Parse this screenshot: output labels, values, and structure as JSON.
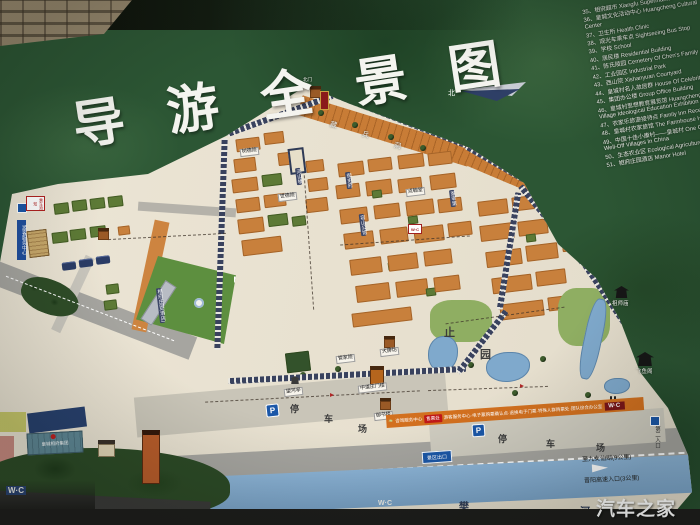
{
  "title": {
    "c1": "导",
    "c2": "游",
    "c3": "全",
    "c4": "景",
    "c5": "图"
  },
  "watermark": "汽车之家",
  "north": {
    "label": "北"
  },
  "legend": {
    "items": [
      "35、相府超市 Xiangfu Supermarket",
      "36、皇城文化活动中心 Huangcheng Cultural Center",
      "37、卫生所 Health Clinic",
      "38、观光车乘车点 Sightseeing Bus Stop",
      "39、学校 School",
      "40、居民楼 Residential Building",
      "41、陈氏陵园 Cemetery Of Chen's Family",
      "42、工业园区 Industrial Park",
      "43、西山院 Xishanyuan Courtyard",
      "44、皇城村名人故居群 House Of Celebrities",
      "45、集团办公楼 Group Office Building",
      "46、皇城村思想教育展览馆 Huangcheng Village Ideological Education Exhibition Hall",
      "47、农家乐旅游接待点 Family Inn Reception",
      "48、皇城村农家旅馆 The Farmhouse Hotel",
      "49、中国十佳小康村——皇城村 One Of Ten Well-Off Villages In China",
      "50、生态农业区 Ecological Agriculture Area",
      "51、相府庄园酒店 Manor Hotel"
    ]
  },
  "sites": {
    "shudeyuan": "树德院",
    "heshanlou": "河山楼",
    "shideyuan": "世德院",
    "cang": "藏",
    "bing": "兵",
    "dong": "洞",
    "yushifu": "御史府",
    "dianhantang": "点翰堂",
    "zhongzaidi": "冢宰第",
    "rongshanguan": "容山公馆",
    "guanjiayuan": "管家院",
    "dapaifang": "大牌坊",
    "zhongdaozhuangmenlou": "中道庄门楼",
    "yushulou": "御书楼",
    "wangheting": "望河亭",
    "zhi": "止",
    "yuan": "园",
    "zushimiao": "祖师庙",
    "feiyuge": "飞鱼阁",
    "beimen": "北门",
    "hotel": "相府庄园(酒店)"
  },
  "west": {
    "notice_sign": "乘车须知",
    "visitor_banner": "游客服务中心",
    "group_building": "皇城相府集团"
  },
  "parking": {
    "p": "P",
    "c1": "停",
    "c2": "车",
    "c3": "场"
  },
  "road_labels": {
    "jiunv": "至九女仙湖(9公里)",
    "expressway": "晋阳高速入口(3公里)",
    "second_entrance": "第二入口",
    "exit_sign": "景区出口"
  },
  "river": {
    "c1": "樊",
    "c2": "河"
  },
  "service_bar": {
    "s1": "咨询服务中心",
    "ticket": "售票处",
    "s2": "游客服务中心·电子票购票确认点·退换电子门票·特殊人群购票处·团队综合办公室",
    "wc": "W·C"
  },
  "wc": "W·C"
}
